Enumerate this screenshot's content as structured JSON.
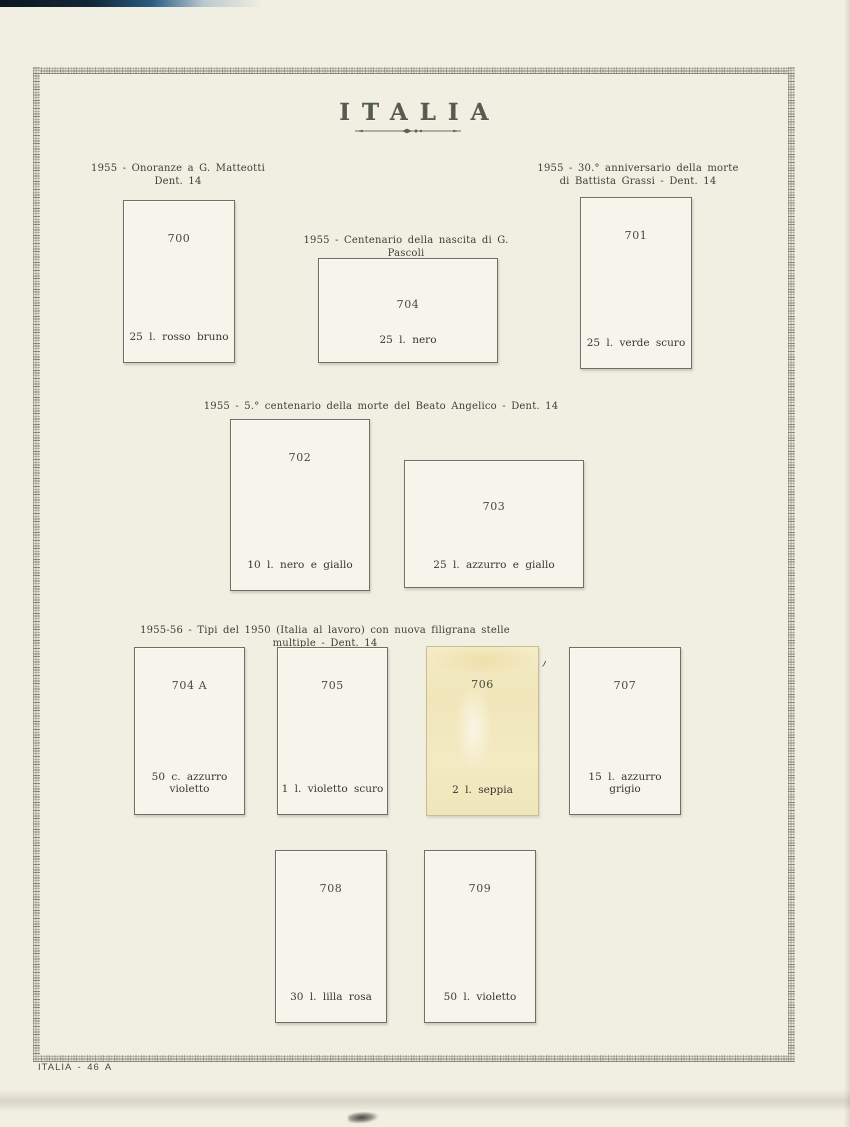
{
  "page": {
    "title": "ITALIA",
    "footer_label": "ITALIA - 46 A"
  },
  "sections": {
    "matteotti": {
      "heading_line1": "1955 - Onoranze a G. Matteotti",
      "heading_line2": "Dent. 14"
    },
    "pascoli": {
      "heading_line1": "1955 - Centenario della nascita di G. Pascoli",
      "heading_line2": "Dent. 14"
    },
    "grassi": {
      "heading_line1": "1955 - 30.° anniversario della morte",
      "heading_line2": "di Battista Grassi - Dent. 14"
    },
    "beato_angelico": {
      "heading_line1": "1955 - 5.° centenario della morte del Beato Angelico - Dent. 14"
    },
    "tipi_1950": {
      "heading_line1": "1955-56 - Tipi del 1950 (Italia al lavoro) con nuova filigrana stelle multiple - Dent. 14"
    }
  },
  "stamps": {
    "s700": {
      "number": "700",
      "caption": "25 l. rosso bruno"
    },
    "s704": {
      "number": "704",
      "caption": "25 l. nero"
    },
    "s701": {
      "number": "701",
      "caption": "25 l. verde scuro"
    },
    "s702": {
      "number": "702",
      "caption": "10 l. nero e giallo"
    },
    "s703": {
      "number": "703",
      "caption": "25 l. azzurro e giallo"
    },
    "s704a": {
      "number": "704 A",
      "caption": "50 c. azzurro violetto"
    },
    "s705": {
      "number": "705",
      "caption": "1 l. violetto scuro"
    },
    "s706": {
      "number": "706",
      "caption": "2 l. seppia"
    },
    "s707": {
      "number": "707",
      "caption": "15 l. azzurro grigio"
    },
    "s708": {
      "number": "708",
      "caption": "30 l. lilla rosa"
    },
    "s709": {
      "number": "709",
      "caption": "50 l. violetto"
    }
  },
  "colors": {
    "page_background": "#f1eee2",
    "box_background": "#f7f5eb",
    "box_border": "#6f6f68",
    "frame_hatch": "#68706 4",
    "text": "#3c4036",
    "title": "#565b50",
    "ghost_stamp_yellow": "#f1e6ba",
    "scan_edge_dark": "#112636"
  }
}
